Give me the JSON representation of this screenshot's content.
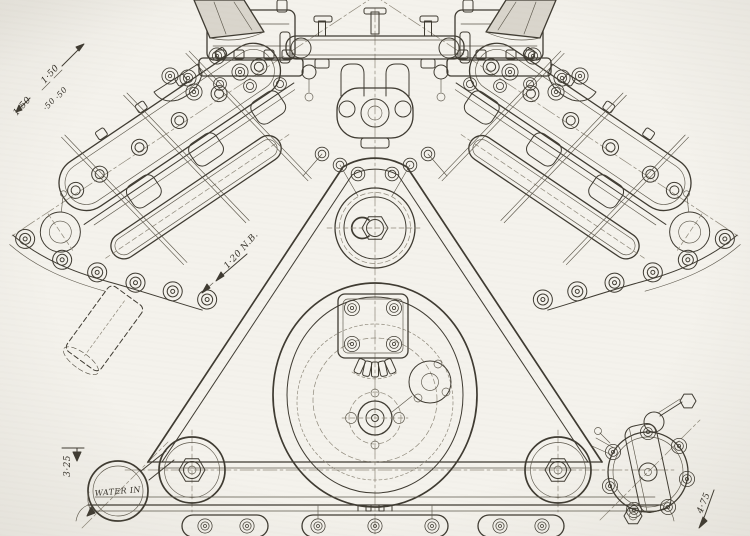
{
  "labels": {
    "dim_a": "1·50",
    "dim_b": "1·50",
    "dim_c": "·50",
    "dim_d": "·50",
    "bore": "1·20 N.B.",
    "water_height": "3·25",
    "water_in": "WATER IN",
    "pump_dim": "4·75"
  }
}
